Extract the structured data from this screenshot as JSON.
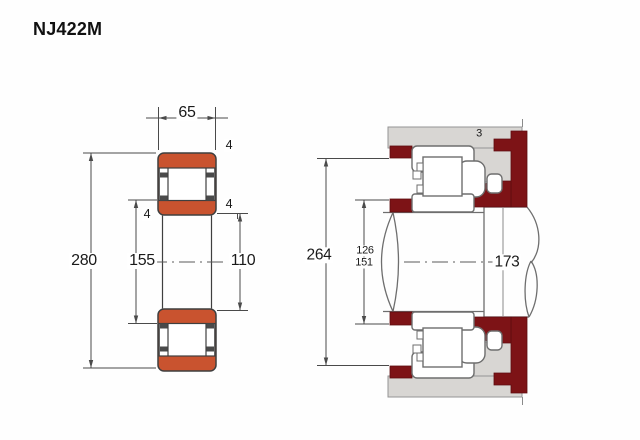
{
  "title": "NJ422M",
  "colors": {
    "orange": "#c9532f",
    "maroon": "#7d1316",
    "housing_gray": "#d8d6d3",
    "text": "#1a1a1a"
  },
  "left_figure": {
    "label": "bearing cross-section",
    "dims": {
      "width_mm": "65",
      "outer_diameter_mm": "280",
      "flange_diameter_mm": "155",
      "bore_diameter_mm": "110",
      "chamfer_outer_mm": "4",
      "chamfer_right_mm": "4",
      "chamfer_left_mm": "4"
    }
  },
  "right_figure": {
    "label": "mounting arrangement",
    "dims": {
      "housing_abutment_diameter_mm": "264",
      "shaft_abutment_min_mm": "126",
      "shaft_abutment_max_mm": "151",
      "shaft_shoulder_diameter_mm": "173",
      "axial_clearance_mm": "3"
    }
  }
}
